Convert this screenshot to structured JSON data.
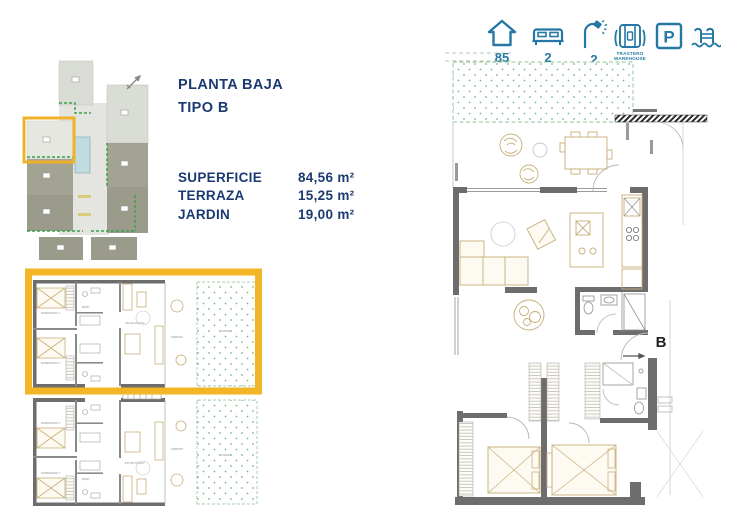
{
  "colors": {
    "navy": "#1b3a70",
    "teal": "#2478a3",
    "highlight_yellow": "#f2b525",
    "wall_gray": "#6d6d6d",
    "furniture_tan": "#c7ae79",
    "garden_green": "#7cb488",
    "hedge_green": "#3aa04a"
  },
  "header": {
    "title_line1": "PLANTA BAJA",
    "title_line2": "TIPO B"
  },
  "measurements": {
    "rows": [
      {
        "label": "SUPERFICIE",
        "value": "84,56 m²"
      },
      {
        "label": "TERRAZA",
        "value": "15,25 m²"
      },
      {
        "label": "JARDIN",
        "value": "19,00 m²"
      }
    ]
  },
  "legend": {
    "area": "85",
    "bedrooms": "2",
    "bathrooms": "2",
    "storage_line1": "TRASTERO",
    "storage_line2": "WAREHOUSE",
    "parking": "P"
  },
  "floorplan": {
    "unit_letter": "B"
  },
  "room_labels": {
    "dorm1": "DORMITORIO 1",
    "dorm2": "DORMITORIO 2",
    "salon": "SALON-COCINA",
    "terraza": "TERRAZA",
    "jardin": "JARDIN",
    "bano": "BAÑO"
  }
}
